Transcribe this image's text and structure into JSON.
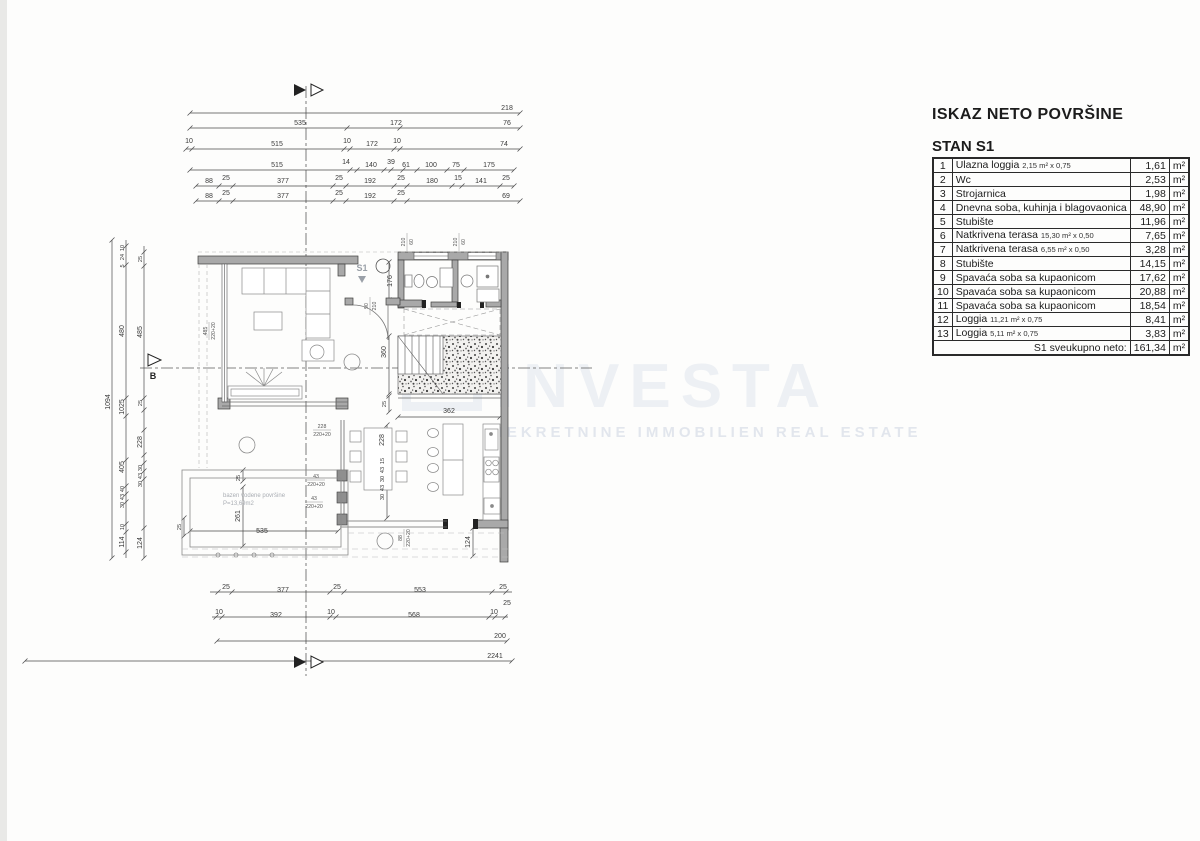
{
  "watermark": {
    "brand": "INVESTA",
    "tagline": "NEKRETNINE IMMOBILIEN REAL ESTATE"
  },
  "area_table": {
    "title": "ISKAZ NETO POVRŠINE",
    "subtitle": "STAN S1",
    "unit": "m²",
    "rows": [
      {
        "num": "1",
        "label": "Ulazna loggia",
        "note": "2,15 m² x 0,75",
        "value": "1,61"
      },
      {
        "num": "2",
        "label": "Wc",
        "note": "",
        "value": "2,53"
      },
      {
        "num": "3",
        "label": "Strojarnica",
        "note": "",
        "value": "1,98"
      },
      {
        "num": "4",
        "label": "Dnevna soba, kuhinja i blagovaonica",
        "note": "",
        "value": "48,90"
      },
      {
        "num": "5",
        "label": "Stubište",
        "note": "",
        "value": "11,96"
      },
      {
        "num": "6",
        "label": "Natkrivena terasa",
        "note": "15,30 m² x 0,50",
        "value": "7,65"
      },
      {
        "num": "7",
        "label": "Natkrivena terasa",
        "note": "6,55 m² x 0,50",
        "value": "3,28"
      },
      {
        "num": "8",
        "label": "Stubište",
        "note": "",
        "value": "14,15"
      },
      {
        "num": "9",
        "label": "Spavaća soba sa kupaonicom",
        "note": "",
        "value": "17,62"
      },
      {
        "num": "10",
        "label": "Spavaća soba sa kupaonicom",
        "note": "",
        "value": "20,88"
      },
      {
        "num": "11",
        "label": "Spavaća soba sa kupaonicom",
        "note": "",
        "value": "18,54"
      },
      {
        "num": "12",
        "label": "Loggia",
        "note": "11,21 m² x 0,75",
        "value": "8,41"
      },
      {
        "num": "13",
        "label": "Loggia",
        "note": "5,11 m² x 0,75",
        "value": "3,83"
      }
    ],
    "total_label": "S1 sveukupno neto:",
    "total_value": "161,34"
  },
  "plan": {
    "unit_label": "S1",
    "section_left": "B",
    "pool_label": "bazen vodene površine",
    "pool_area": "P=13,69m2",
    "dim_labels": [
      {
        "t": "218",
        "x": 507,
        "y": 110
      },
      {
        "t": "535",
        "x": 300,
        "y": 125
      },
      {
        "t": "172",
        "x": 396,
        "y": 125
      },
      {
        "t": "76",
        "x": 507,
        "y": 125
      },
      {
        "t": "10",
        "x": 189,
        "y": 143
      },
      {
        "t": "515",
        "x": 277,
        "y": 146
      },
      {
        "t": "10",
        "x": 347,
        "y": 143
      },
      {
        "t": "172",
        "x": 372,
        "y": 146
      },
      {
        "t": "10",
        "x": 397,
        "y": 143
      },
      {
        "t": "74",
        "x": 504,
        "y": 146
      },
      {
        "t": "515",
        "x": 277,
        "y": 167
      },
      {
        "t": "14",
        "x": 346,
        "y": 164
      },
      {
        "t": "140",
        "x": 371,
        "y": 167
      },
      {
        "t": "39",
        "x": 391,
        "y": 164
      },
      {
        "t": "61",
        "x": 406,
        "y": 167
      },
      {
        "t": "100",
        "x": 431,
        "y": 167
      },
      {
        "t": "75",
        "x": 456,
        "y": 167
      },
      {
        "t": "175",
        "x": 489,
        "y": 167
      },
      {
        "t": "88",
        "x": 209,
        "y": 183
      },
      {
        "t": "25",
        "x": 226,
        "y": 180
      },
      {
        "t": "377",
        "x": 283,
        "y": 183
      },
      {
        "t": "25",
        "x": 339,
        "y": 180
      },
      {
        "t": "192",
        "x": 370,
        "y": 183
      },
      {
        "t": "25",
        "x": 401,
        "y": 180
      },
      {
        "t": "180",
        "x": 432,
        "y": 183
      },
      {
        "t": "15",
        "x": 458,
        "y": 180
      },
      {
        "t": "141",
        "x": 481,
        "y": 183
      },
      {
        "t": "25",
        "x": 506,
        "y": 180
      },
      {
        "t": "88",
        "x": 209,
        "y": 198
      },
      {
        "t": "25",
        "x": 226,
        "y": 195
      },
      {
        "t": "377",
        "x": 283,
        "y": 198
      },
      {
        "t": "25",
        "x": 339,
        "y": 195
      },
      {
        "t": "192",
        "x": 370,
        "y": 198
      },
      {
        "t": "25",
        "x": 401,
        "y": 195
      },
      {
        "t": "69",
        "x": 506,
        "y": 198
      },
      {
        "t": "1094",
        "x": 110,
        "y": 402,
        "r": 1
      },
      {
        "t": "10",
        "x": 124,
        "y": 248,
        "r": 1,
        "s": 1
      },
      {
        "t": "24",
        "x": 124,
        "y": 257,
        "r": 1,
        "s": 1
      },
      {
        "t": "5",
        "x": 124,
        "y": 266,
        "r": 1,
        "s": 1
      },
      {
        "t": "480",
        "x": 124,
        "y": 331,
        "r": 1
      },
      {
        "t": "1025",
        "x": 124,
        "y": 407,
        "r": 1
      },
      {
        "t": "405",
        "x": 124,
        "y": 467,
        "r": 1
      },
      {
        "t": "40",
        "x": 124,
        "y": 489,
        "r": 1,
        "s": 1
      },
      {
        "t": "43",
        "x": 124,
        "y": 497,
        "r": 1,
        "s": 1
      },
      {
        "t": "30",
        "x": 124,
        "y": 505,
        "r": 1,
        "s": 1
      },
      {
        "t": "10",
        "x": 124,
        "y": 527,
        "r": 1,
        "s": 1
      },
      {
        "t": "114",
        "x": 124,
        "y": 542,
        "r": 1
      },
      {
        "t": "25",
        "x": 142,
        "y": 259,
        "r": 1,
        "s": 1
      },
      {
        "t": "485",
        "x": 142,
        "y": 332,
        "r": 1
      },
      {
        "t": "25",
        "x": 142,
        "y": 403,
        "r": 1,
        "s": 1
      },
      {
        "t": "228",
        "x": 142,
        "y": 442,
        "r": 1
      },
      {
        "t": "30",
        "x": 142,
        "y": 468,
        "r": 1,
        "s": 1
      },
      {
        "t": "43",
        "x": 142,
        "y": 476,
        "r": 1,
        "s": 1
      },
      {
        "t": "30",
        "x": 142,
        "y": 484,
        "r": 1,
        "s": 1
      },
      {
        "t": "124",
        "x": 142,
        "y": 543,
        "r": 1
      },
      {
        "t": "25",
        "x": 226,
        "y": 589
      },
      {
        "t": "377",
        "x": 283,
        "y": 592
      },
      {
        "t": "25",
        "x": 337,
        "y": 589
      },
      {
        "t": "553",
        "x": 420,
        "y": 592
      },
      {
        "t": "25",
        "x": 503,
        "y": 589
      },
      {
        "t": "25",
        "x": 507,
        "y": 605
      },
      {
        "t": "10",
        "x": 219,
        "y": 614
      },
      {
        "t": "392",
        "x": 276,
        "y": 617
      },
      {
        "t": "10",
        "x": 331,
        "y": 614
      },
      {
        "t": "568",
        "x": 414,
        "y": 617
      },
      {
        "t": "10",
        "x": 494,
        "y": 614
      },
      {
        "t": "200",
        "x": 500,
        "y": 638
      },
      {
        "t": "2241",
        "x": 495,
        "y": 658
      },
      {
        "t": "176",
        "x": 392,
        "y": 281,
        "r": 1
      },
      {
        "t": "360",
        "x": 386,
        "y": 352,
        "r": 1
      },
      {
        "t": "25",
        "x": 386,
        "y": 404,
        "r": 1,
        "s": 1
      },
      {
        "t": "362",
        "x": 449,
        "y": 413
      },
      {
        "t": "228",
        "x": 384,
        "y": 440,
        "r": 1
      },
      {
        "t": "15",
        "x": 384,
        "y": 461,
        "r": 1,
        "s": 1
      },
      {
        "t": "43",
        "x": 384,
        "y": 470,
        "r": 1,
        "s": 1
      },
      {
        "t": "30",
        "x": 384,
        "y": 479,
        "r": 1,
        "s": 1
      },
      {
        "t": "43",
        "x": 384,
        "y": 488,
        "r": 1,
        "s": 1
      },
      {
        "t": "30",
        "x": 384,
        "y": 497,
        "r": 1,
        "s": 1
      },
      {
        "t": "25",
        "x": 240,
        "y": 478,
        "r": 1,
        "s": 1
      },
      {
        "t": "261",
        "x": 240,
        "y": 516,
        "r": 1
      },
      {
        "t": "535",
        "x": 262,
        "y": 533
      },
      {
        "t": "25",
        "x": 181,
        "y": 527,
        "r": 1,
        "s": 1
      },
      {
        "t": "124",
        "x": 470,
        "y": 542,
        "r": 1
      }
    ],
    "frac_labels": [
      {
        "top": "228",
        "bottom": "220+20",
        "x": 322,
        "y": 430
      },
      {
        "top": "43",
        "bottom": "220+20",
        "x": 316,
        "y": 480
      },
      {
        "top": "43",
        "bottom": "220+20",
        "x": 314,
        "y": 502
      },
      {
        "top": "88",
        "bottom": "220+20",
        "x": 404,
        "y": 538,
        "r": 1
      },
      {
        "top": "485",
        "bottom": "220+20",
        "x": 209,
        "y": 331,
        "r": 1
      },
      {
        "top": "90",
        "bottom": "210",
        "x": 370,
        "y": 306,
        "r": 1
      },
      {
        "top": "210",
        "bottom": "60",
        "x": 407,
        "y": 242,
        "r": 1
      },
      {
        "top": "210",
        "bottom": "60",
        "x": 459,
        "y": 242,
        "r": 1
      }
    ]
  }
}
